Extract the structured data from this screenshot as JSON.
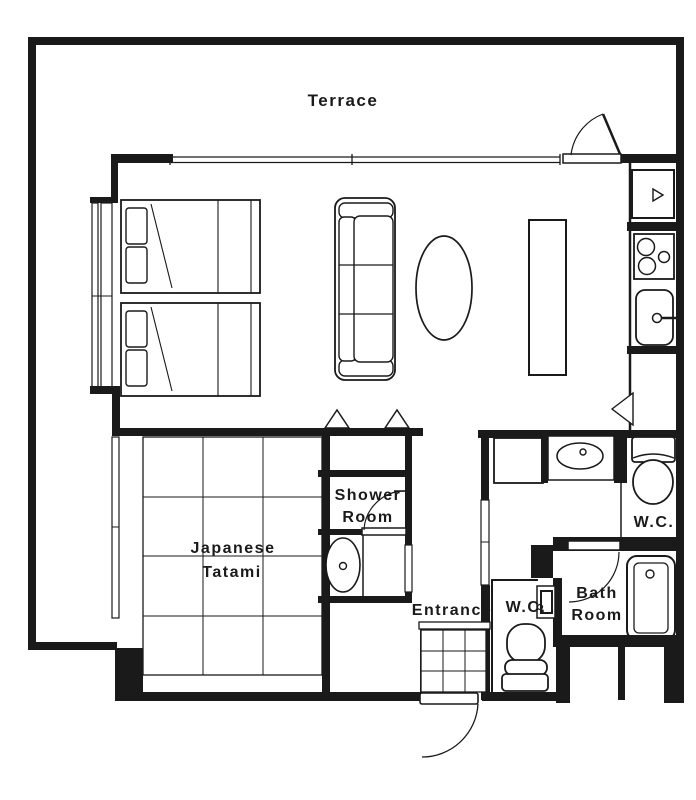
{
  "colors": {
    "line": "#1a1a1a",
    "background": "#ffffff"
  },
  "labels": {
    "terrace": "Terrace",
    "shower_room": [
      "Shower",
      "Room"
    ],
    "japanese_tatami": [
      "Japanese",
      "Tatami"
    ],
    "entrance": "Entrance",
    "wc_entrance": "W.C.",
    "bath_room": [
      "Bath",
      "Room"
    ],
    "wc_main": "W.C."
  },
  "fixtures": {
    "bedroom": [
      "twin-bed",
      "twin-bed",
      "window"
    ],
    "living_dining": [
      "sofa",
      "coffee-table",
      "kitchen-island"
    ],
    "kitchen": [
      "refrigerator",
      "stove",
      "kitchen-sink"
    ],
    "tatami_room": [
      "tatami-mat-grid",
      "window"
    ],
    "closet": [
      "folding-doors"
    ],
    "shower_room": [
      "door-swing",
      "washbasin"
    ],
    "washroom": [
      "cabinet",
      "vanity-washbasin"
    ],
    "wc_main": [
      "toilet"
    ],
    "bath_room": [
      "door-swing",
      "bathtub"
    ],
    "wc_entrance": [
      "toilet",
      "hand-basin"
    ],
    "entrance": [
      "tile-floor",
      "entry-door-swing"
    ],
    "terrace": [
      "terrace-door-swing",
      "full-width-window"
    ]
  }
}
